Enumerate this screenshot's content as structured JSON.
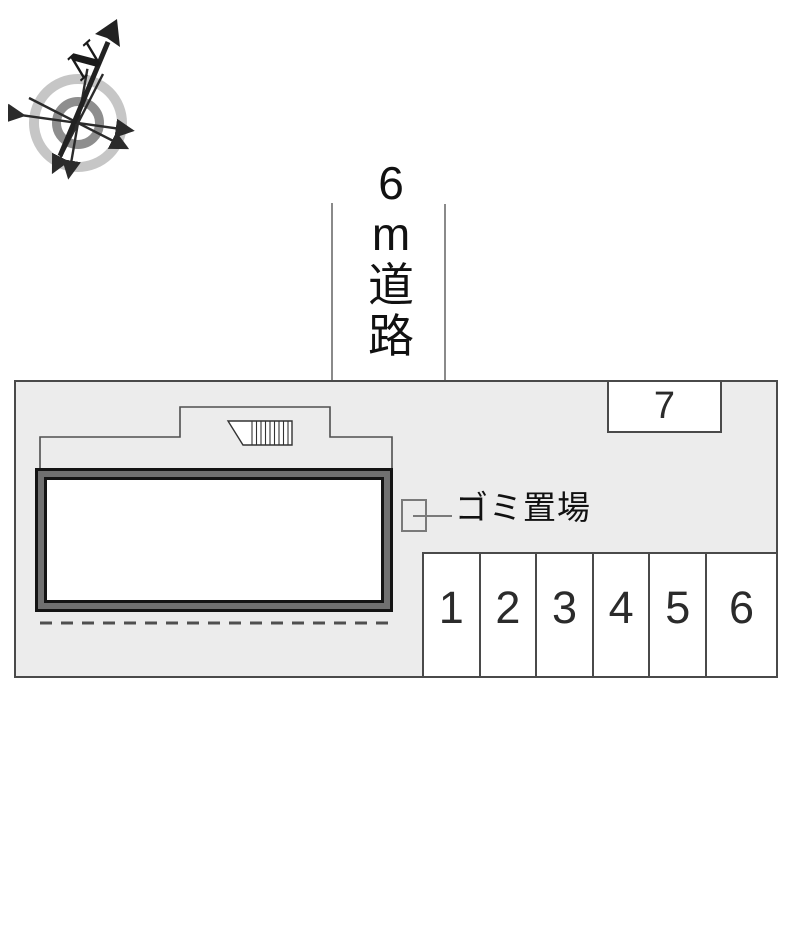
{
  "compass": {
    "north_label": "N"
  },
  "road": {
    "label_text": "6m道路",
    "label_chars": [
      "6",
      "m",
      "道",
      "路"
    ]
  },
  "site": {
    "garbage_label": "ゴミ置場",
    "parking_stalls": [
      "1",
      "2",
      "3",
      "4",
      "5",
      "6"
    ],
    "stall_7_label": "7"
  },
  "colors": {
    "site_fill": "#ececec",
    "site_border": "#4a4a4a",
    "building_band": "#707070",
    "building_line": "#141414",
    "outline_line": "#4f4f4f",
    "road_line": "#8a8a8a",
    "compass_ring_outer": "#c6c6c6",
    "compass_ring_inner": "#8e8e8e",
    "ink": "#1a1a1a"
  }
}
